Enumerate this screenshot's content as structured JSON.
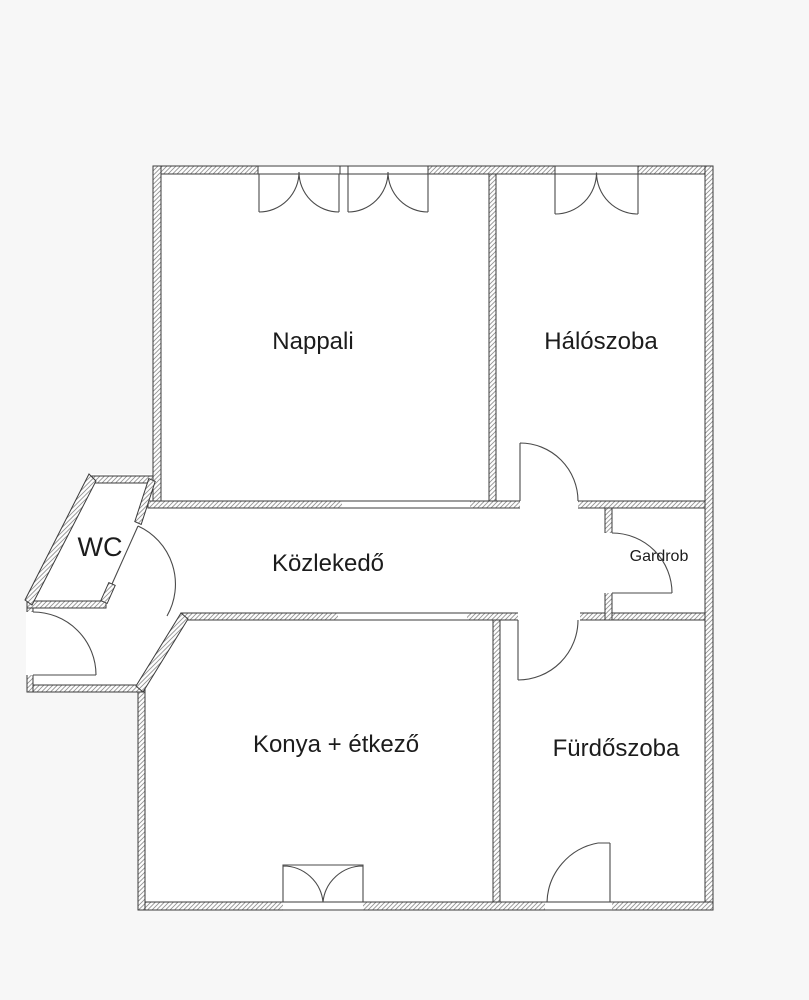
{
  "floorplan": {
    "colors": {
      "page_background": "#f7f7f7",
      "floor": "#ffffff",
      "wall_line": "#3b3b3b",
      "wall_hatch": "#8f8f8f",
      "label_text": "#1c1c1c"
    },
    "rooms": [
      {
        "id": "nappali",
        "label": "Nappali"
      },
      {
        "id": "haloszoba",
        "label": "Hálószoba"
      },
      {
        "id": "wc",
        "label": "WC"
      },
      {
        "id": "kozlekedo",
        "label": "Közlekedő"
      },
      {
        "id": "gardrob",
        "label": "Gardrob"
      },
      {
        "id": "konya-etkezo",
        "label": "Konya + étkező"
      },
      {
        "id": "furdoszoba",
        "label": "Fürdőszoba"
      }
    ]
  }
}
